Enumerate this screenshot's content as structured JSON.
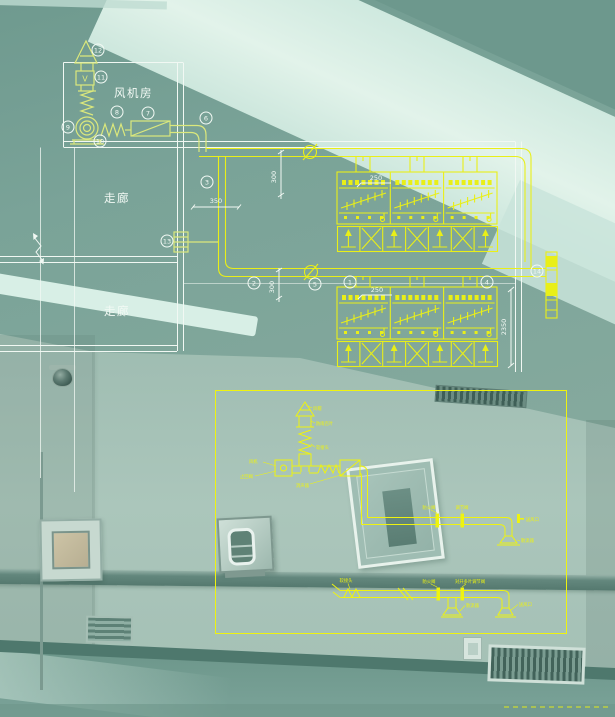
{
  "colors": {
    "photo_teal": "#85a89c",
    "ceiling_light": "#d9efe6",
    "rail_dark": "#5a7e74",
    "cad_pale_yellow": "#dbe87c",
    "cad_yellow": "#e9ef18",
    "cad_detail_yellow": "#eef310",
    "line_white": "#f1f8f3"
  },
  "cad_upper": {
    "rooms": {
      "fan_room": "风机房",
      "corridor_a": "走廊",
      "corridor_b": "走廊"
    },
    "valve_letter": "V",
    "callout_labels": [
      "1",
      "2",
      "3",
      "4",
      "5",
      "6",
      "7",
      "8",
      "9",
      "10",
      "11",
      "12",
      "13",
      "14"
    ],
    "dimensions": {
      "run1_offset": "300",
      "duct_width": "350",
      "unit1_inlet": "250",
      "run2_offset": "300",
      "unit2_inlet": "250",
      "unit_height": "2350"
    }
  },
  "cad_detail": {
    "labels": {
      "rain_cap": "风帽",
      "rain_louver": "防雨百叶",
      "flex_joint": "软接头",
      "fan": "风机",
      "check_valve": "止回阀",
      "silencer": "消声器",
      "a_fire_damper": "防火阀",
      "a_reg_damper": "调节阀",
      "a_outlet": "送风口",
      "a_diffuser": "散流器",
      "b_flex": "软接头",
      "b_fire_damper": "防火阀",
      "b_reg_damper": "对开多叶调节阀",
      "b_diffuser": "散流器",
      "b_outlet": "送风口"
    }
  }
}
